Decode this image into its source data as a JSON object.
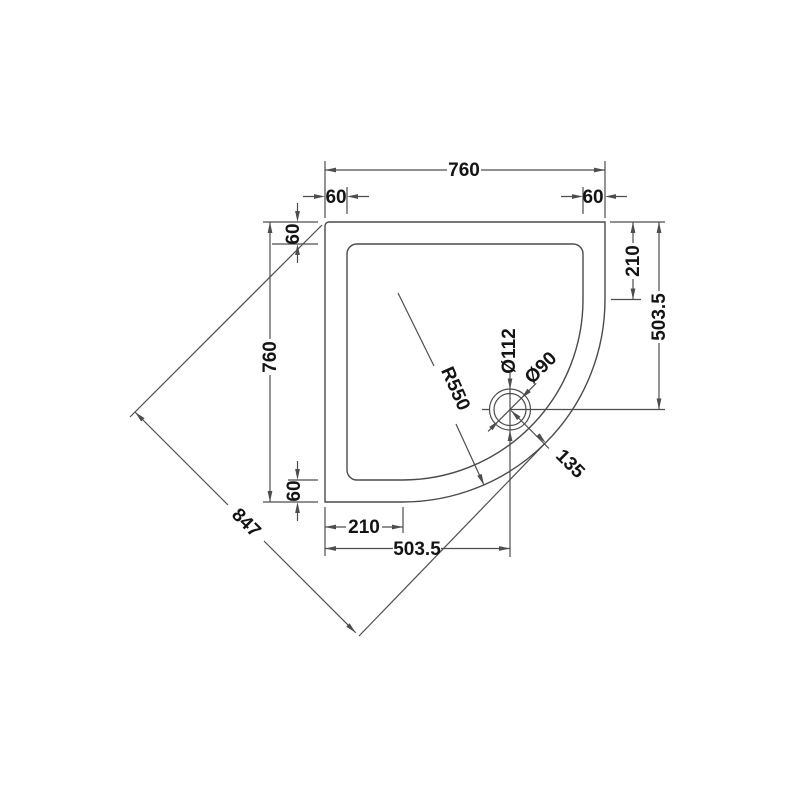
{
  "drawing": {
    "title": "Quadrant shower tray dimension drawing",
    "labels": {
      "top_width": "760",
      "top_rim_left": "60",
      "top_rim_right": "60",
      "left_rim_top": "60",
      "left_height": "760",
      "left_rim_bottom": "60",
      "right_edge": "210",
      "right_drain": "503.5",
      "bottom_edge": "210",
      "bottom_drain": "503.5",
      "diagonal": "847",
      "radius": "R550",
      "waste_outer": "Ø112",
      "waste_inner": "Ø90",
      "drain_offset": "135"
    },
    "colors": {
      "background": "#ffffff",
      "line": "#4d4d4d",
      "text": "#141414"
    }
  }
}
